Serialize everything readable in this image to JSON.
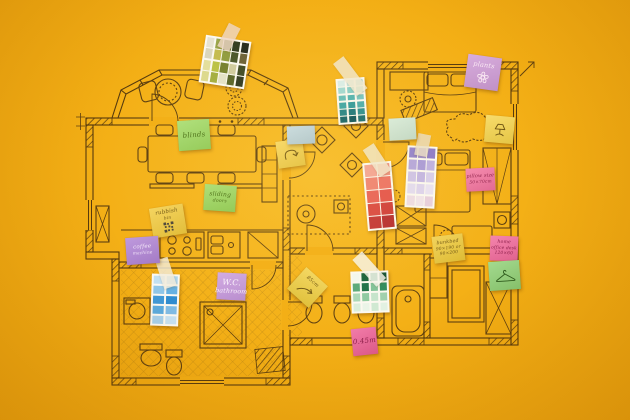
{
  "scene": {
    "description": "Hand-drawn apartment floor plan on a yellow background, annotated with sticky notes and paint swatch cards",
    "background_color": "#f3ae14",
    "ink_color": "#563a0e"
  },
  "floor_plan": {
    "style": "hand-drawn brown ink with hatched walls",
    "wall_color": "#563a0e"
  },
  "sticky_notes": [
    {
      "id": "blinds",
      "color": "#9ad95f",
      "ink": "#456c15",
      "fs": 7,
      "x": 178,
      "y": 120,
      "w": 32,
      "h": 30,
      "rot": -4,
      "lines": [
        "blinds"
      ]
    },
    {
      "id": "sliding-doors",
      "color": "#96d75a",
      "ink": "#456c15",
      "fs": 6,
      "x": 204,
      "y": 185,
      "w": 32,
      "h": 26,
      "rot": 4,
      "lines": [
        "sliding",
        "doors"
      ]
    },
    {
      "id": "rubbish-bin",
      "color": "#f2ca3b",
      "ink": "#6e5412",
      "fs": 5.5,
      "x": 151,
      "y": 206,
      "w": 34,
      "h": 30,
      "rot": -9,
      "lines": [
        "rubbish",
        "bin"
      ],
      "doodle": "qr"
    },
    {
      "id": "coffee-machine",
      "color": "#b083d6",
      "ink": "#f4e7fa",
      "fs": 5.5,
      "x": 126,
      "y": 237,
      "w": 33,
      "h": 27,
      "rot": -4,
      "lines": [
        "coffee",
        "machine"
      ]
    },
    {
      "id": "wc",
      "color": "#c697e0",
      "ink": "#faf2fe",
      "fs": 8,
      "x": 217,
      "y": 273,
      "w": 29,
      "h": 27,
      "rot": 3,
      "lines": [
        "W.C.",
        "bathroom"
      ]
    },
    {
      "id": "plants",
      "color": "#cf9bd6",
      "ink": "#fbeaf4",
      "fs": 6.5,
      "x": 466,
      "y": 56,
      "w": 34,
      "h": 33,
      "rot": 8,
      "lines": [
        "plants"
      ],
      "doodle": "flower"
    },
    {
      "id": "pillow-size",
      "color": "#f36f9f",
      "ink": "#8c1f4a",
      "fs": 4.8,
      "x": 466,
      "y": 168,
      "w": 29,
      "h": 23,
      "rot": -3,
      "lines": [
        "pillow size",
        "50×70cm"
      ]
    },
    {
      "id": "bunkbed",
      "color": "#eec937",
      "ink": "#6e5412",
      "fs": 4.8,
      "x": 433,
      "y": 235,
      "w": 31,
      "h": 27,
      "rot": -7,
      "lines": [
        "bunkbed",
        "90×190 or",
        "90×200"
      ]
    },
    {
      "id": "home-office-desk",
      "color": "#f2699b",
      "ink": "#8c1f4a",
      "fs": 4.6,
      "x": 490,
      "y": 236,
      "w": 28,
      "h": 25,
      "rot": 2,
      "lines": [
        "home",
        "office desk",
        "120×60"
      ]
    },
    {
      "id": "door-width",
      "color": "#ee5f95",
      "ink": "#8c1f4a",
      "fs": 7,
      "x": 352,
      "y": 328,
      "w": 25,
      "h": 27,
      "rot": -6,
      "lines": [
        "0.45m"
      ]
    },
    {
      "id": "curve-arrow-note",
      "color": "#f5cf45",
      "ink": "#6e5412",
      "fs": 6,
      "x": 277,
      "y": 140,
      "w": 27,
      "h": 27,
      "rot": -8,
      "lines": [],
      "doodle": "curve-arrow"
    },
    {
      "id": "width-85",
      "color": "#f0ce3e",
      "ink": "#6e5412",
      "fs": 5,
      "x": 293,
      "y": 273,
      "w": 29,
      "h": 29,
      "rot": 42,
      "lines": [
        "85cm"
      ],
      "doodle": "arrow"
    },
    {
      "id": "lamp-note",
      "color": "#f6d44a",
      "ink": "#6e5412",
      "fs": 6,
      "x": 485,
      "y": 116,
      "w": 29,
      "h": 27,
      "rot": 5,
      "lines": [],
      "doodle": "lamp"
    },
    {
      "id": "hanger-note",
      "color": "#8fd276",
      "ink": "#2e5c1e",
      "fs": 6,
      "x": 489,
      "y": 261,
      "w": 31,
      "h": 29,
      "rot": -4,
      "lines": [],
      "doodle": "hanger"
    },
    {
      "id": "mint-blank",
      "color": "#cfe8d8",
      "ink": "#3a5a40",
      "fs": 6,
      "x": 389,
      "y": 118,
      "w": 27,
      "h": 22,
      "rot": -3,
      "lines": []
    },
    {
      "id": "blue-blank",
      "color": "#b9d4e4",
      "ink": "#31506a",
      "fs": 6,
      "x": 287,
      "y": 126,
      "w": 28,
      "h": 18,
      "rot": -2,
      "lines": []
    }
  ],
  "swatch_cards": [
    {
      "id": "olive",
      "x": 202,
      "y": 38,
      "w": 46,
      "h": 48,
      "rot": 9,
      "tape": {
        "color": "#efd6c5",
        "rot": 18,
        "len": 26
      },
      "rows": [
        [
          "#e7e3d4",
          "#9aa74b",
          "#5d6d2f",
          "#303b21",
          "#23291c"
        ],
        [
          "#d9d6c0",
          "#c3bb4e",
          "#8f9c3f",
          "#47542a",
          "#6a6036"
        ],
        [
          "#e3df9d",
          "#b9c145",
          "#747f2e",
          "#cfcb9f",
          "#3c4824"
        ],
        [
          "#dcd98f",
          "#a2ad3f",
          "#e4e2c9",
          "#566228",
          "#2d3620"
        ]
      ]
    },
    {
      "id": "teal",
      "x": 337,
      "y": 78,
      "w": 29,
      "h": 46,
      "rot": -4,
      "tape": {
        "color": "#f1e8d2",
        "rot": -33,
        "len": 40
      },
      "rows": [
        [
          "#d8eeec",
          "#c2e5e3",
          "#addcd9"
        ],
        [
          "#9fd8d5",
          "#86cdca",
          "#93d2cf"
        ],
        [
          "#62bcbb",
          "#4fb2b2",
          "#74c4c2"
        ],
        [
          "#3aa3a6",
          "#2d989c",
          "#49abad"
        ],
        [
          "#1f8187",
          "#17747b",
          "#288c90"
        ],
        [
          "#0f6068",
          "#0a525b",
          "#156a71"
        ]
      ]
    },
    {
      "id": "red",
      "x": 365,
      "y": 162,
      "w": 29,
      "h": 68,
      "rot": -5,
      "tape": {
        "color": "#f1e8d2",
        "rot": -28,
        "len": 32
      },
      "rows": [
        [
          "#f3a296",
          "#f09184"
        ],
        [
          "#ee8073",
          "#ec6f64"
        ],
        [
          "#e85f57",
          "#e3504a"
        ],
        [
          "#d94440",
          "#cf3a39"
        ],
        [
          "#c23234",
          "#b52a2f"
        ]
      ]
    },
    {
      "id": "lilac",
      "x": 406,
      "y": 146,
      "w": 30,
      "h": 62,
      "rot": 3,
      "tape": {
        "color": "#e9ddc6",
        "rot": 8,
        "len": 22
      },
      "rows": [
        [
          "#9181cf",
          "#a293d8",
          "#8a79ca"
        ],
        [
          "#b3a5df",
          "#a899da",
          "#bcafe4"
        ],
        [
          "#cdc2eb",
          "#c2b5e6",
          "#d6cdef"
        ],
        [
          "#e2dbf4",
          "#dcd3f1",
          "#e8e2f6"
        ],
        [
          "#eddce8",
          "#f0e4ee",
          "#e6cfe0"
        ]
      ]
    },
    {
      "id": "green",
      "x": 351,
      "y": 271,
      "w": 38,
      "h": 42,
      "rot": -2,
      "tape": {
        "color": "#f8f6f0",
        "rot": -40,
        "len": 36
      },
      "rows": [
        [
          "#f2f7f1",
          "#15613d",
          "#2e8b5e",
          "#0f5034"
        ],
        [
          "#57a87a",
          "#1b6f48",
          "#7fc29a",
          "#2e8b5e"
        ],
        [
          "#a8d7b8",
          "#8cc9a2",
          "#c4e4cd",
          "#9ed0ae"
        ],
        [
          "#d9eedd",
          "#eaf5ea",
          "#cfe9d4",
          "#e2f1e4"
        ]
      ]
    },
    {
      "id": "blue",
      "x": 151,
      "y": 274,
      "w": 28,
      "h": 52,
      "rot": 2,
      "tape": {
        "color": "#f3ecdb",
        "rot": -20,
        "len": 30
      },
      "rows": [
        [
          "#c2e0f2",
          "#add5ee"
        ],
        [
          "#8fc6e9",
          "#66b1e2"
        ],
        [
          "#3f98d7",
          "#2f8cd0"
        ],
        [
          "#5aaade",
          "#7fbce6"
        ],
        [
          "#a6d0ec",
          "#c6e2f4"
        ]
      ]
    }
  ]
}
